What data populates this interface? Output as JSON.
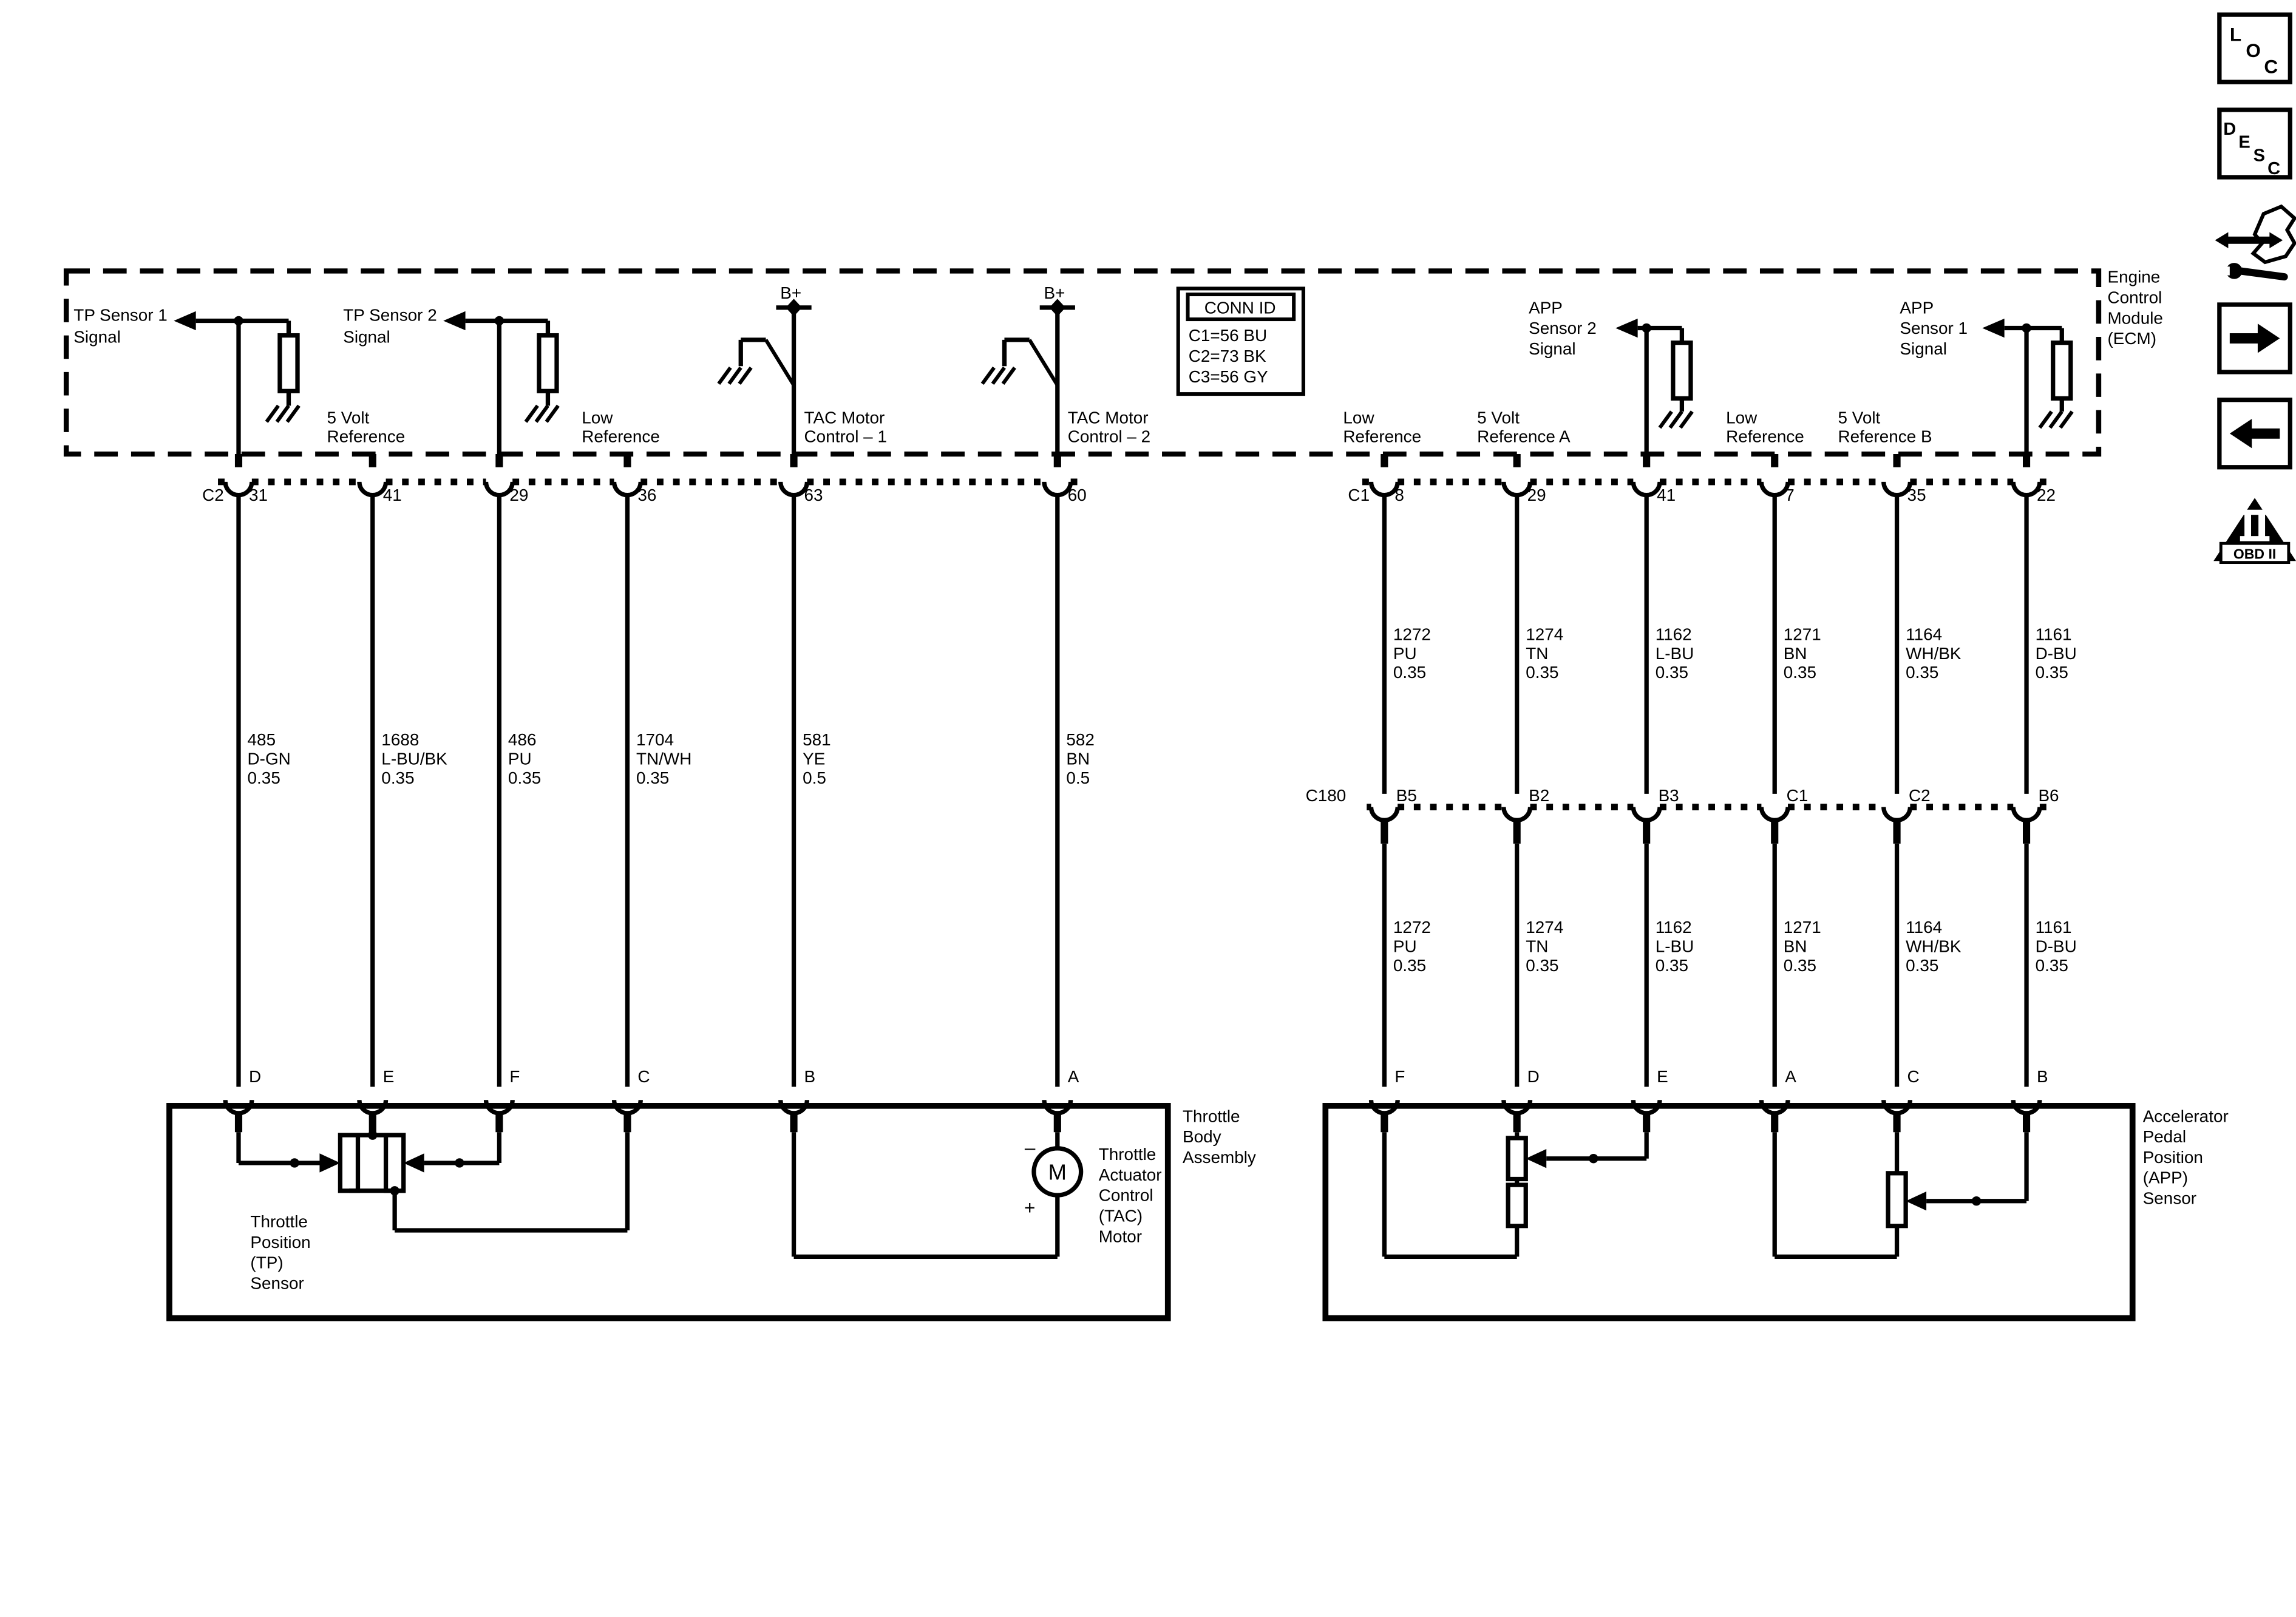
{
  "icons": {
    "loc": [
      "L",
      "O",
      "C"
    ],
    "desc": [
      "D",
      "E",
      "S",
      "C"
    ],
    "obd": {
      "numeral": "II",
      "label": "OBD II"
    },
    "names": [
      "location-icon",
      "description-icon",
      "harness-wrench-icon",
      "forward-arrow-icon",
      "back-arrow-icon",
      "obd2-icon"
    ]
  },
  "ecm": {
    "label": [
      "Engine",
      "Control",
      "Module",
      "(ECM)"
    ],
    "tp1": [
      "TP Sensor 1",
      "Signal"
    ],
    "tp2": [
      "TP Sensor 2",
      "Signal"
    ],
    "five_volt": [
      "5 Volt",
      "Reference"
    ],
    "low_ref": [
      "Low",
      "Reference"
    ],
    "bplus": "B+",
    "tac1": [
      "TAC Motor",
      "Control – 1"
    ],
    "tac2": [
      "TAC Motor",
      "Control – 2"
    ],
    "app2": [
      "APP",
      "Sensor 2",
      "Signal"
    ],
    "app1": [
      "APP",
      "Sensor 1",
      "Signal"
    ],
    "low_ref_a": [
      "Low",
      "Reference"
    ],
    "five_volt_a": [
      "5 Volt",
      "Reference A"
    ],
    "low_ref_b": [
      "Low",
      "Reference"
    ],
    "five_volt_b": [
      "5 Volt",
      "Reference B"
    ]
  },
  "conn_id": {
    "title": "CONN ID",
    "rows": [
      "C1=56 BU",
      "C2=73 BK",
      "C3=56 GY"
    ]
  },
  "top_row": {
    "left_connector": "C2",
    "right_connector": "C1",
    "left": [
      "31",
      "41",
      "29",
      "36",
      "63",
      "60"
    ],
    "right": [
      "8",
      "29",
      "41",
      "7",
      "35",
      "22"
    ]
  },
  "wires": {
    "left": [
      [
        "485",
        "D-GN",
        "0.35"
      ],
      [
        "1688",
        "L-BU/BK",
        "0.35"
      ],
      [
        "486",
        "PU",
        "0.35"
      ],
      [
        "1704",
        "TN/WH",
        "0.35"
      ],
      [
        "581",
        "YE",
        "0.5"
      ],
      [
        "582",
        "BN",
        "0.5"
      ]
    ],
    "right": [
      [
        "1272",
        "PU",
        "0.35"
      ],
      [
        "1274",
        "TN",
        "0.35"
      ],
      [
        "1162",
        "L-BU",
        "0.35"
      ],
      [
        "1271",
        "BN",
        "0.35"
      ],
      [
        "1164",
        "WH/BK",
        "0.35"
      ],
      [
        "1161",
        "D-BU",
        "0.35"
      ]
    ]
  },
  "c180": {
    "label": "C180",
    "pins": [
      "B5",
      "B2",
      "B3",
      "C1",
      "C2",
      "B6"
    ]
  },
  "bottom_row": {
    "left": [
      "D",
      "E",
      "F",
      "C",
      "B",
      "A"
    ],
    "right": [
      "F",
      "D",
      "E",
      "A",
      "C",
      "B"
    ]
  },
  "throttle_body": {
    "label": [
      "Throttle",
      "Body",
      "Assembly"
    ],
    "tp": [
      "Throttle",
      "Position",
      "(TP)",
      "Sensor"
    ],
    "tac": [
      "Throttle",
      "Actuator",
      "Control",
      "(TAC)",
      "Motor"
    ],
    "motor": "M",
    "minus": "–",
    "plus": "+"
  },
  "app_sensor": {
    "label": [
      "Accelerator",
      "Pedal",
      "Position",
      "(APP)",
      "Sensor"
    ]
  }
}
